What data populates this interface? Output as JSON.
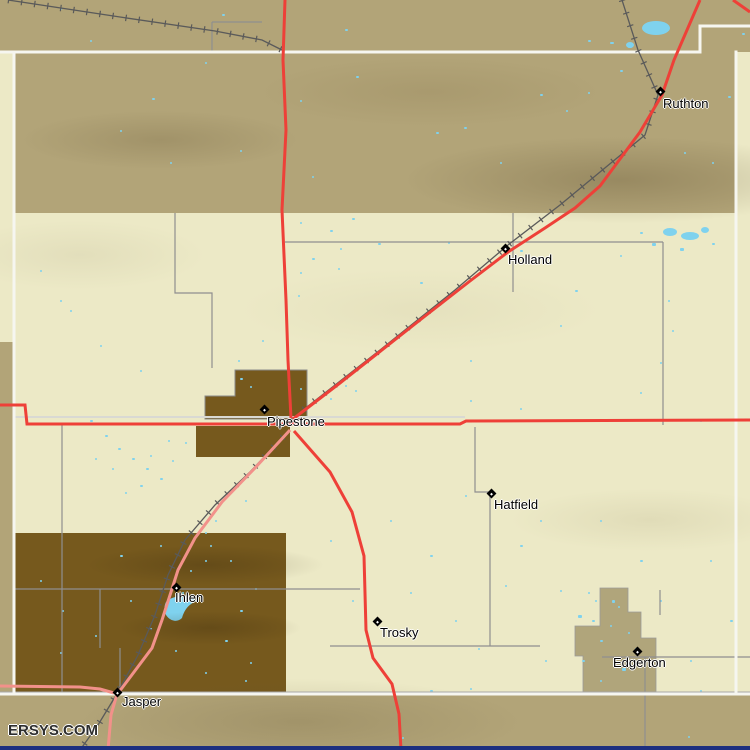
{
  "map": {
    "watermark": "ERSYS.COM",
    "towns": [
      {
        "name": "Ruthton",
        "x": 660,
        "y": 91,
        "dx": 3,
        "dy": 6
      },
      {
        "name": "Holland",
        "x": 505,
        "y": 248,
        "dx": 3,
        "dy": 5
      },
      {
        "name": "Pipestone",
        "x": 264,
        "y": 409,
        "dx": 3,
        "dy": 6
      },
      {
        "name": "Hatfield",
        "x": 491,
        "y": 493,
        "dx": 3,
        "dy": 5
      },
      {
        "name": "Trosky",
        "x": 377,
        "y": 621,
        "dx": 3,
        "dy": 5
      },
      {
        "name": "Edgerton",
        "x": 637,
        "y": 651,
        "dx": -24,
        "dy": 5
      },
      {
        "name": "Ihlen",
        "x": 176,
        "y": 587,
        "dx": -1,
        "dy": 4
      },
      {
        "name": "Jasper",
        "x": 117,
        "y": 692,
        "dx": 5,
        "dy": 3
      }
    ],
    "colors": {
      "land_outside": "#b2a478",
      "county_fill": "#ece9c6",
      "urban_brown": "#76591d",
      "urban_tan": "#b0a57b",
      "water": "#7fd2ee",
      "highway_red": "#ee4038",
      "road_pink": "#f2918a",
      "road_gray": "#8f8f8f",
      "railroad": "#5a5a5a",
      "boundary_white": "#f6f6f0",
      "footer_bar": "#1c2f80",
      "label_color": "#000000",
      "watermark_color": "#2e2e2e"
    },
    "water_dots": [
      [
        222,
        14,
        3,
        2
      ],
      [
        345,
        29,
        3,
        2
      ],
      [
        588,
        40,
        3,
        2
      ],
      [
        610,
        42,
        4,
        2
      ],
      [
        742,
        33,
        3,
        2
      ],
      [
        90,
        40,
        2,
        2
      ],
      [
        60,
        8,
        2,
        2
      ],
      [
        152,
        98,
        3,
        2
      ],
      [
        205,
        62,
        2,
        2
      ],
      [
        300,
        100,
        2,
        2
      ],
      [
        356,
        76,
        3,
        2
      ],
      [
        436,
        132,
        3,
        2
      ],
      [
        464,
        127,
        3,
        2
      ],
      [
        540,
        94,
        3,
        2
      ],
      [
        566,
        110,
        2,
        2
      ],
      [
        588,
        92,
        2,
        2
      ],
      [
        620,
        70,
        3,
        2
      ],
      [
        698,
        104,
        3,
        2
      ],
      [
        728,
        96,
        3,
        2
      ],
      [
        684,
        152,
        2,
        2
      ],
      [
        712,
        162,
        2,
        2
      ],
      [
        500,
        162,
        2,
        2
      ],
      [
        312,
        176,
        2,
        2
      ],
      [
        240,
        150,
        2,
        2
      ],
      [
        120,
        130,
        2,
        2
      ],
      [
        170,
        162,
        2,
        2
      ],
      [
        628,
        45,
        4,
        3
      ],
      [
        300,
        222,
        2,
        2
      ],
      [
        330,
        230,
        3,
        2
      ],
      [
        352,
        218,
        3,
        2
      ],
      [
        340,
        248,
        2,
        2
      ],
      [
        312,
        258,
        3,
        2
      ],
      [
        300,
        272,
        2,
        2
      ],
      [
        338,
        268,
        2,
        2
      ],
      [
        378,
        243,
        3,
        2
      ],
      [
        420,
        282,
        3,
        2
      ],
      [
        298,
        295,
        2,
        2
      ],
      [
        520,
        250,
        3,
        2
      ],
      [
        575,
        290,
        3,
        2
      ],
      [
        620,
        255,
        2,
        2
      ],
      [
        40,
        270,
        2,
        2
      ],
      [
        70,
        310,
        2,
        2
      ],
      [
        100,
        345,
        2,
        2
      ],
      [
        140,
        370,
        2,
        2
      ],
      [
        60,
        300,
        2,
        2
      ],
      [
        448,
        242,
        2,
        2
      ],
      [
        560,
        325,
        2,
        2
      ],
      [
        470,
        360,
        2,
        2
      ],
      [
        652,
        243,
        4,
        3
      ],
      [
        680,
        248,
        4,
        3
      ],
      [
        712,
        243,
        3,
        2
      ],
      [
        640,
        232,
        3,
        2
      ],
      [
        90,
        420,
        3,
        2
      ],
      [
        105,
        435,
        3,
        2
      ],
      [
        118,
        448,
        3,
        2
      ],
      [
        132,
        458,
        3,
        2
      ],
      [
        146,
        468,
        3,
        2
      ],
      [
        112,
        468,
        2,
        2
      ],
      [
        95,
        458,
        2,
        2
      ],
      [
        160,
        478,
        3,
        2
      ],
      [
        172,
        460,
        2,
        2
      ],
      [
        185,
        442,
        2,
        2
      ],
      [
        140,
        485,
        3,
        2
      ],
      [
        125,
        492,
        2,
        2
      ],
      [
        150,
        455,
        2,
        2
      ],
      [
        168,
        440,
        2,
        2
      ],
      [
        240,
        378,
        3,
        2
      ],
      [
        250,
        386,
        2,
        2
      ],
      [
        300,
        388,
        2,
        2
      ],
      [
        345,
        385,
        2,
        2
      ],
      [
        330,
        398,
        2,
        2
      ],
      [
        355,
        390,
        2,
        2
      ],
      [
        238,
        360,
        2,
        2
      ],
      [
        262,
        340,
        2,
        2
      ],
      [
        470,
        400,
        2,
        2
      ],
      [
        520,
        408,
        2,
        2
      ],
      [
        668,
        300,
        2,
        2
      ],
      [
        672,
        330,
        2,
        2
      ],
      [
        660,
        362,
        2,
        2
      ],
      [
        640,
        392,
        2,
        2
      ],
      [
        700,
        420,
        2,
        2
      ],
      [
        430,
        555,
        3,
        2
      ],
      [
        465,
        495,
        2,
        2
      ],
      [
        520,
        545,
        3,
        2
      ],
      [
        540,
        520,
        2,
        2
      ],
      [
        600,
        520,
        2,
        2
      ],
      [
        640,
        560,
        3,
        2
      ],
      [
        352,
        600,
        2,
        2
      ],
      [
        410,
        592,
        2,
        2
      ],
      [
        455,
        620,
        2,
        2
      ],
      [
        478,
        648,
        2,
        2
      ],
      [
        560,
        590,
        2,
        2
      ],
      [
        710,
        560,
        2,
        2
      ],
      [
        730,
        620,
        3,
        2
      ],
      [
        690,
        660,
        2,
        2
      ],
      [
        545,
        660,
        2,
        2
      ],
      [
        430,
        690,
        3,
        2
      ],
      [
        470,
        688,
        2,
        2
      ],
      [
        505,
        585,
        2,
        2
      ],
      [
        330,
        540,
        2,
        2
      ],
      [
        390,
        520,
        2,
        2
      ],
      [
        600,
        680,
        2,
        2
      ],
      [
        660,
        600,
        2,
        2
      ],
      [
        700,
        690,
        2,
        2
      ],
      [
        120,
        555,
        3,
        2
      ],
      [
        205,
        560,
        2,
        2
      ],
      [
        240,
        610,
        3,
        2
      ],
      [
        255,
        588,
        2,
        2
      ],
      [
        225,
        640,
        3,
        2
      ],
      [
        250,
        662,
        2,
        2
      ],
      [
        130,
        600,
        2,
        2
      ],
      [
        95,
        635,
        2,
        2
      ],
      [
        60,
        652,
        2,
        2
      ],
      [
        160,
        545,
        2,
        2
      ],
      [
        230,
        490,
        2,
        2
      ],
      [
        245,
        500,
        2,
        2
      ],
      [
        215,
        520,
        2,
        2
      ],
      [
        205,
        532,
        2,
        2
      ],
      [
        210,
        545,
        2,
        2
      ],
      [
        190,
        570,
        2,
        2
      ],
      [
        182,
        592,
        2,
        2
      ],
      [
        230,
        560,
        2,
        2
      ],
      [
        150,
        628,
        2,
        2
      ],
      [
        175,
        650,
        2,
        2
      ],
      [
        205,
        672,
        2,
        2
      ],
      [
        245,
        680,
        2,
        2
      ],
      [
        62,
        610,
        2,
        2
      ],
      [
        40,
        580,
        2,
        2
      ],
      [
        578,
        615,
        4,
        3
      ],
      [
        592,
        620,
        3,
        2
      ],
      [
        612,
        600,
        3,
        3
      ],
      [
        618,
        606,
        2,
        2
      ],
      [
        600,
        640,
        3,
        2
      ],
      [
        582,
        660,
        3,
        2
      ],
      [
        635,
        648,
        2,
        2
      ],
      [
        622,
        668,
        4,
        3
      ],
      [
        610,
        625,
        2,
        2
      ],
      [
        628,
        632,
        2,
        2
      ],
      [
        595,
        600,
        2,
        2
      ],
      [
        588,
        592,
        2,
        2
      ],
      [
        402,
        737,
        2,
        2
      ],
      [
        688,
        736,
        2,
        2
      ]
    ]
  }
}
